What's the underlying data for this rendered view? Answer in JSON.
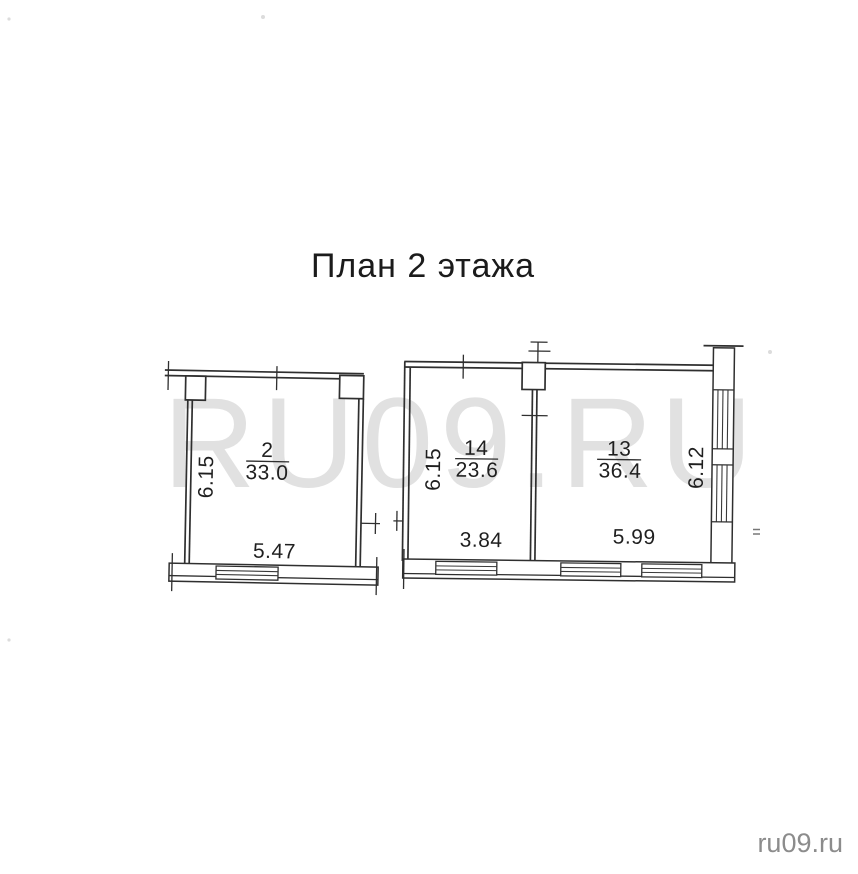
{
  "plan": {
    "title": "План 2 этажа",
    "rooms": [
      {
        "number": "2",
        "area": "33.0",
        "width_m": "5.47",
        "height_m": "6.15"
      },
      {
        "number": "14",
        "area": "23.6",
        "width_m": "3.84",
        "height_m": "6.15"
      },
      {
        "number": "13",
        "area": "36.4",
        "width_m": "5.99",
        "height_m": "6.12"
      }
    ]
  },
  "watermark": {
    "center": "RU09.RU",
    "corner": "ru09.ru"
  },
  "colors": {
    "ink": "#2f2f2f",
    "label_text": "#1f1f1f",
    "watermark_center": "#e1e1e1",
    "watermark_corner": "#8c8c8c",
    "background": "#ffffff"
  }
}
